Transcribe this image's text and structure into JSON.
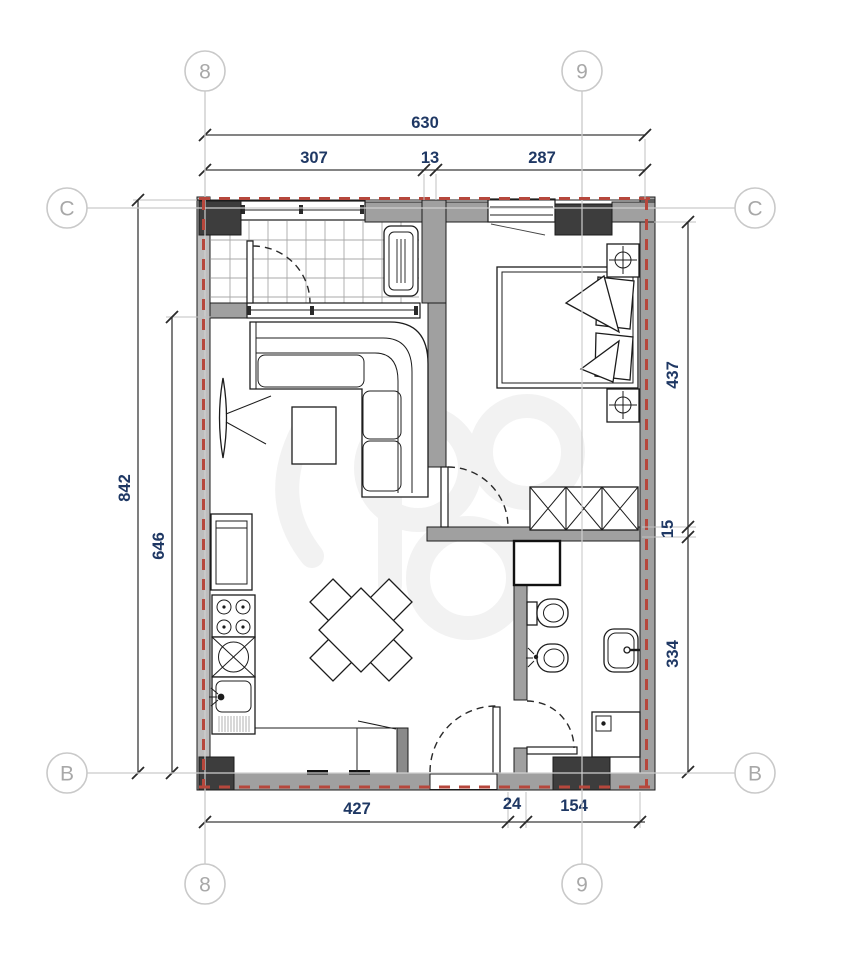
{
  "grid_markers": {
    "top": [
      "8",
      "9"
    ],
    "bottom": [
      "8",
      "9"
    ],
    "left": [
      "C",
      "B"
    ],
    "right": [
      "C",
      "B"
    ]
  },
  "dimensions": {
    "top_total": "630",
    "top_segments": [
      "307",
      "13",
      "287"
    ],
    "left_outer": "842",
    "left_inner": "646",
    "right_segments": [
      "437",
      "15",
      "334"
    ],
    "bottom_segments": [
      "427",
      "24",
      "154"
    ]
  },
  "colors": {
    "wall_gray": "#a0a0a0",
    "wall_light": "#bdbdbd",
    "pier_dark": "#3d3d3d",
    "boundary_red": "#b6473c",
    "dimension_text": "#1f3864",
    "grid_line": "#c9c9c9",
    "grid_label": "#a8a8a8",
    "watermark": "#f2f2f2"
  },
  "furniture_icons": [
    "tiled-balcony",
    "ac-unit-icon",
    "corner-sofa-icon",
    "coffee-table-icon",
    "tv-panel-icon",
    "dining-table-icon",
    "dining-chair-icon",
    "refrigerator-icon",
    "stove-burners-icon",
    "cabinet-x-icon",
    "kitchen-sink-icon",
    "double-bed-icon",
    "pillow-icon",
    "nightstand-lamp-icon",
    "wardrobe-x-icon",
    "vent-shaft-icon",
    "toilet-icon",
    "bidet-icon",
    "washbasin-icon",
    "washing-machine-icon",
    "door-swing-icon",
    "entry-door-swing-icon"
  ]
}
